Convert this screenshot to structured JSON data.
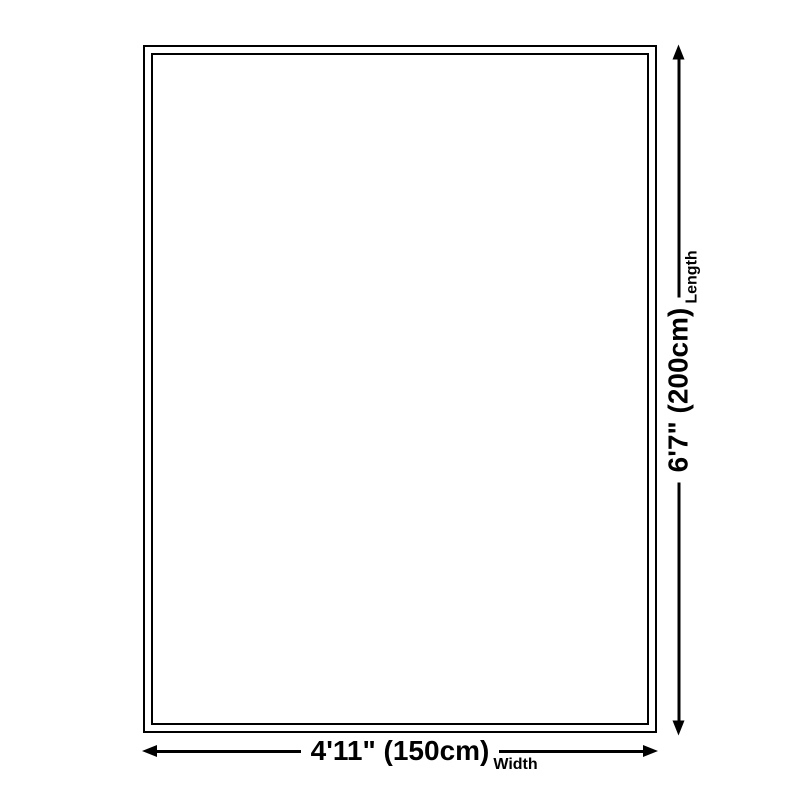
{
  "diagram": {
    "title": "rug-size-diagram",
    "width_dim": {
      "value": "4'11\" (150cm)",
      "label": "Width"
    },
    "length_dim": {
      "value": "6'7\" (200cm)",
      "label": "Length"
    },
    "colors": {
      "line": "#000000",
      "background": "#ffffff"
    }
  }
}
